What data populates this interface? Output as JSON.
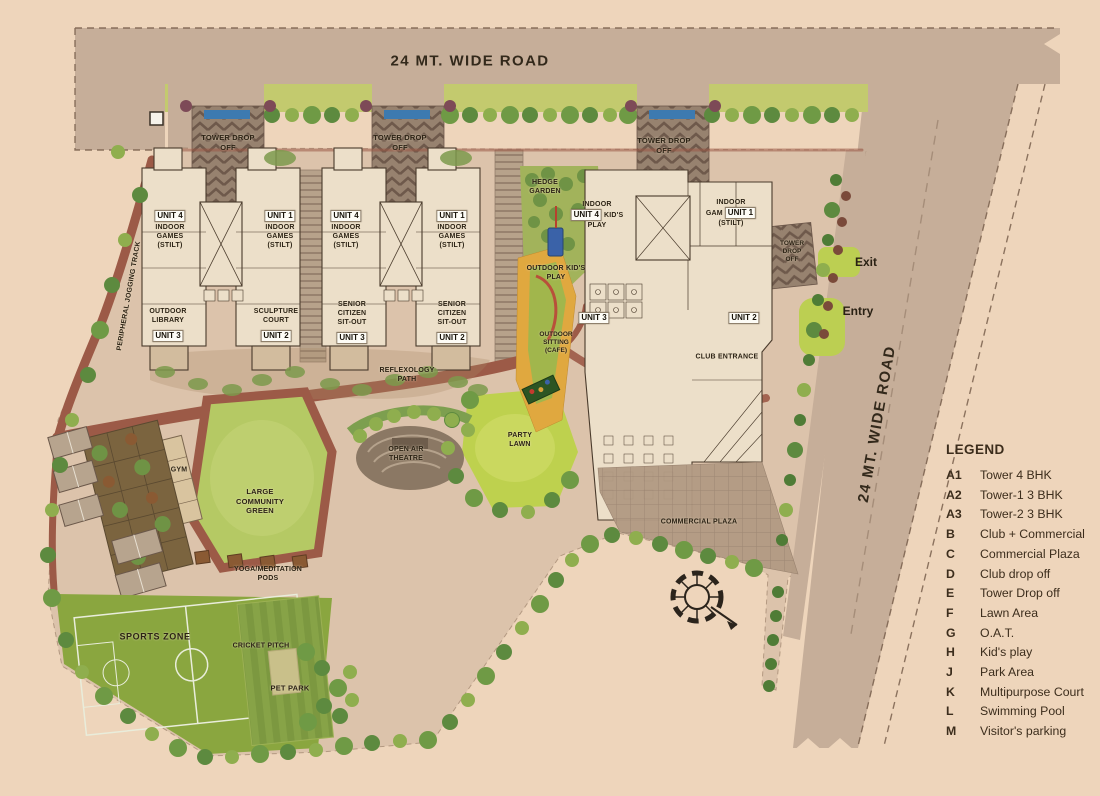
{
  "colors": {
    "background": "#eed5bb",
    "road": "#c6ae99",
    "verge_green": "#c3ca6e",
    "lawn_green": "#bed14e",
    "community_green": "#b5c964",
    "track_red": "#9c5a47",
    "building_cream": "#ecdfc9",
    "outline_dark": "#4a3b2c",
    "sports_green": "#8aa63f",
    "play_orange": "#e0a83f",
    "pool_blue": "#3a62a8",
    "sign_blue": "#3d7ab0",
    "text_dark": "#2c2315"
  },
  "plan": {
    "road_top": "24 MT. WIDE ROAD",
    "road_right": "24 MT. WIDE ROAD",
    "exit": "Exit",
    "entry": "Entry",
    "drop_off": [
      "TOWER DROP",
      "OFF"
    ],
    "drop_off_right": [
      "TOWER",
      "DROP",
      "OFF"
    ],
    "jogging_track": "PERIPHERAL JOGGING TRACK",
    "chips": {
      "u1": "UNIT 1",
      "u2": "UNIT 2",
      "u3": "UNIT 3",
      "u4": "UNIT 4"
    },
    "stilt_lines": [
      "INDOOR",
      "GAMES",
      "(STILT)"
    ],
    "outdoor_library": [
      "OUTDOOR",
      "LIBRARY"
    ],
    "sculpture_court": [
      "SCULPTURE",
      "COURT"
    ],
    "senior_citizen": [
      "SENIOR",
      "CITIZEN",
      "SIT-OUT"
    ],
    "hedge_garden": [
      "HEDGE",
      "GARDEN"
    ],
    "indoor_kids": {
      "l1": "INDOOR",
      "l2": "KID'S",
      "l3": "PLAY"
    },
    "indoor_gam": {
      "l1": "INDOOR",
      "l2": "GAM",
      "l3": "(STILT)"
    },
    "outdoor_kids": [
      "OUTDOOR KID'S",
      "PLAY"
    ],
    "outdoor_sitting": [
      "OUTDOOR",
      "SITTING",
      "(CAFE)"
    ],
    "club_entrance": "CLUB ENTRANCE",
    "commercial_plaza": "COMMERCIAL PLAZA",
    "reflexology": [
      "REFLEXOLOGY",
      "PATH"
    ],
    "party_lawn": [
      "PARTY",
      "LAWN"
    ],
    "oat": [
      "OPEN AIR",
      "THEATRE"
    ],
    "gym": "GYM",
    "community_green": [
      "LARGE",
      "COMMUNITY",
      "GREEN"
    ],
    "yoga_pods": [
      "YOGA/MEDITATION",
      "PODS"
    ],
    "sports_zone": "SPORTS ZONE",
    "cricket_pitch": "CRICKET PITCH",
    "pet_park": "PET PARK"
  },
  "legend": {
    "title": "LEGEND",
    "items": [
      {
        "k": "A1",
        "v": "Tower 4 BHK"
      },
      {
        "k": "A2",
        "v": "Tower-1 3 BHK"
      },
      {
        "k": "A3",
        "v": "Tower-2 3 BHK"
      },
      {
        "k": "B",
        "v": "Club + Commercial"
      },
      {
        "k": "C",
        "v": "Commercial Plaza"
      },
      {
        "k": "D",
        "v": "Club drop off"
      },
      {
        "k": "E",
        "v": "Tower Drop off"
      },
      {
        "k": "F",
        "v": "Lawn Area"
      },
      {
        "k": "G",
        "v": "O.A.T."
      },
      {
        "k": "H",
        "v": "Kid's play"
      },
      {
        "k": "J",
        "v": "Park Area"
      },
      {
        "k": "K",
        "v": "Multipurpose Court"
      },
      {
        "k": "L",
        "v": "Swimming Pool"
      },
      {
        "k": "M",
        "v": "Visitor's parking"
      }
    ]
  }
}
